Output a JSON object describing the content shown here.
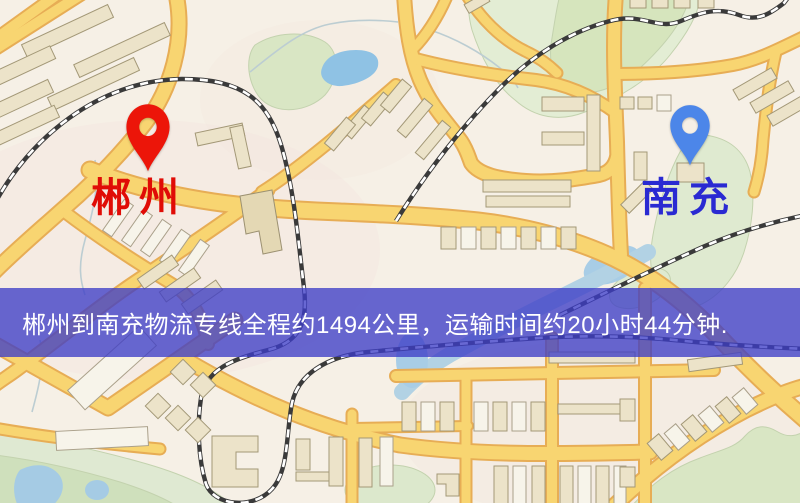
{
  "map": {
    "markers": [
      {
        "name": "郴州",
        "type": "origin",
        "pin_color": "#ec1509",
        "label_color": "#e00c06",
        "pin_tip": {
          "x": 148,
          "y": 173
        },
        "pin_size": {
          "w": 46,
          "h": 70
        },
        "label_pos": {
          "x": 139,
          "y": 178
        }
      },
      {
        "name": "南充",
        "type": "destination",
        "pin_color": "#4c86e9",
        "label_color": "#2a2ad2",
        "pin_tip": {
          "x": 690,
          "y": 167
        },
        "pin_size": {
          "w": 42,
          "h": 63
        },
        "label_pos": {
          "x": 689,
          "y": 178
        }
      }
    ],
    "banner": {
      "text": "郴州到南充物流专线全程约1494公里，运输时间约20小时44分钟.",
      "background": "rgba(62,62,198,0.78)",
      "text_color": "#ffffff",
      "top": 288,
      "height": 69,
      "font_size": 24
    }
  }
}
